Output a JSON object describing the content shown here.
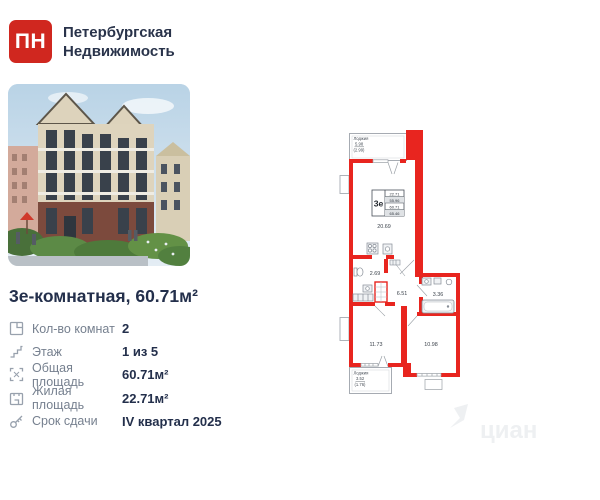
{
  "brand": {
    "logo_text": "ПН",
    "name_line1": "Петербургская",
    "name_line2": "Недвижимость",
    "logo_color": "#d0271f"
  },
  "listing": {
    "title": "3е-комнатная, 60.71м²",
    "details": [
      {
        "icon": "rooms-icon",
        "label": "Кол-во комнат",
        "value": "2"
      },
      {
        "icon": "floor-icon",
        "label": "Этаж",
        "value": "1 из 5"
      },
      {
        "icon": "total-area-icon",
        "label": "Общая площадь",
        "value": "60.71м²"
      },
      {
        "icon": "living-area-icon",
        "label": "Жилая площадь",
        "value": "22.71м²"
      },
      {
        "icon": "key-icon",
        "label": "Срок сдачи",
        "value": "IV квартал 2025"
      }
    ]
  },
  "floorplan": {
    "wall_color": "#e8251f",
    "stamp": {
      "type": "3е",
      "values": [
        "22.71",
        "55.96",
        "60.71",
        "65.46"
      ]
    },
    "rooms": {
      "kitchen_living": "20.69",
      "wc": "2.69",
      "hall": "6.51",
      "bathroom": "3.36",
      "bedroom_1": "11.73",
      "bedroom_2": "10.98"
    },
    "loggia_top": {
      "label": "Лоджия",
      "area": "5.98",
      "reduced": "(2.99)"
    },
    "loggia_bottom": {
      "label": "Лоджия",
      "area": "3.52",
      "reduced": "(1.76)"
    }
  },
  "watermark": {
    "text": "циан"
  }
}
